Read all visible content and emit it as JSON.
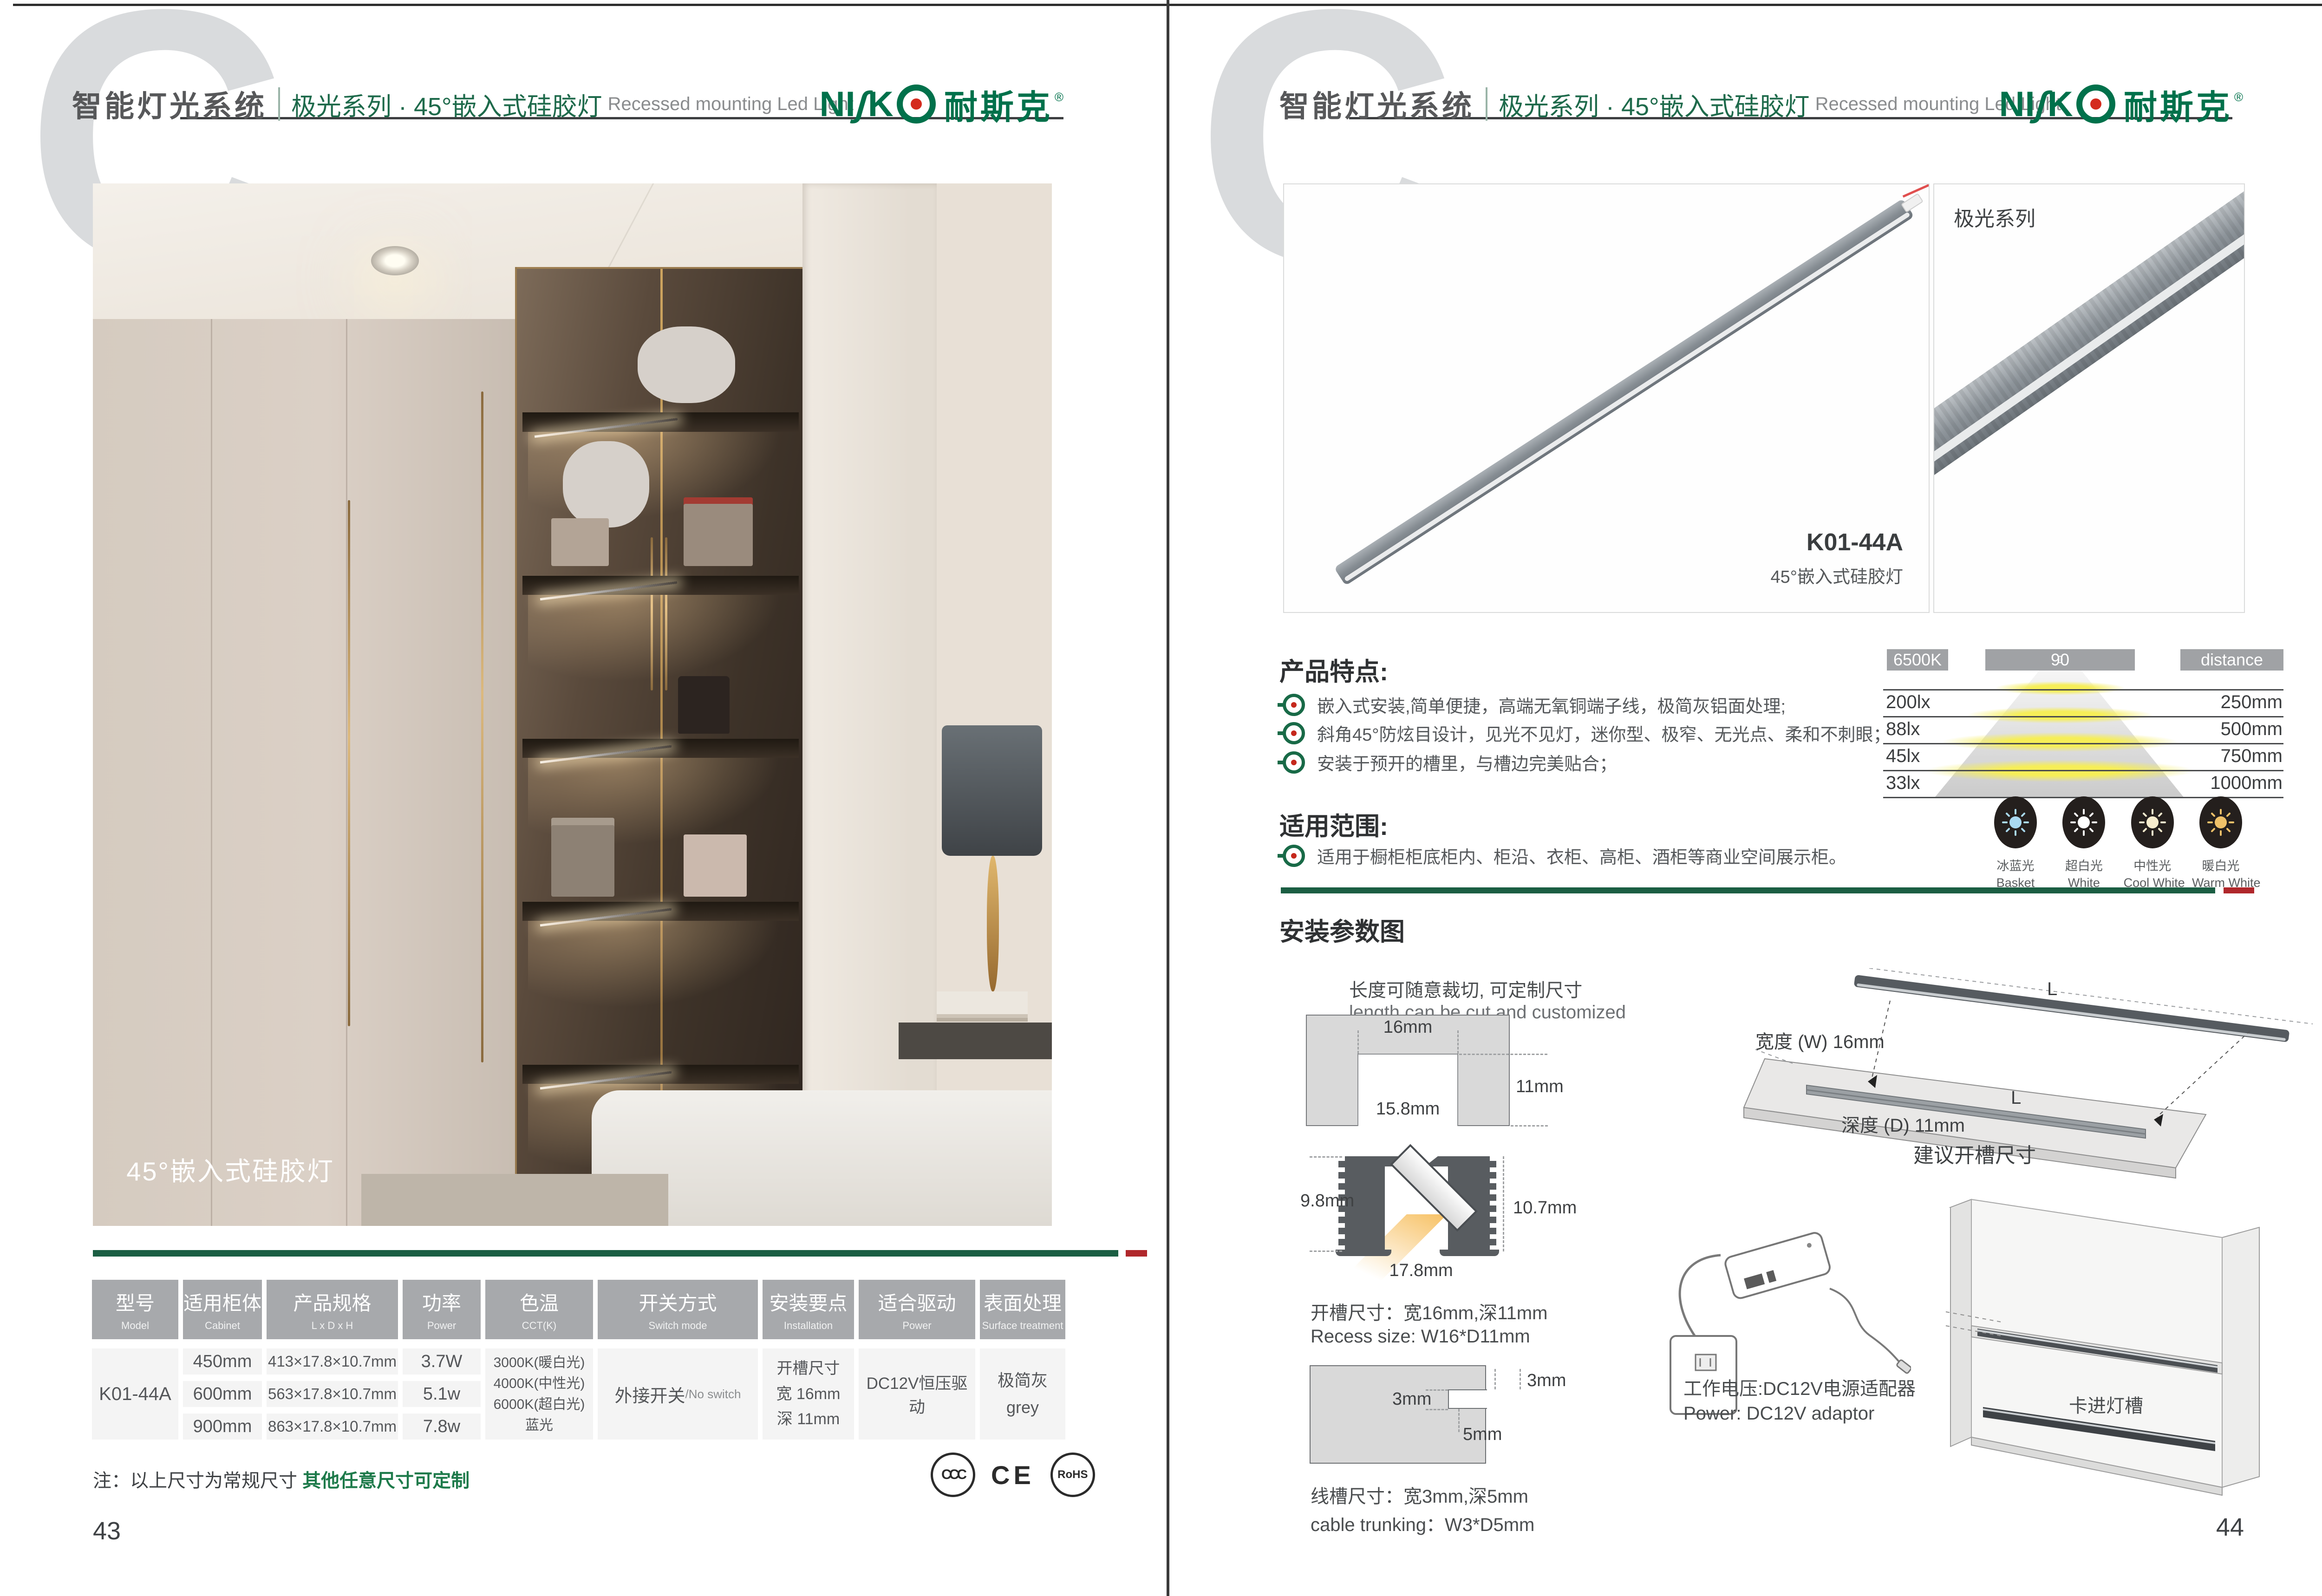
{
  "colors": {
    "brand_green": "#00714b",
    "series_green": "#1e6a4b",
    "divider_green": "#1b5e43",
    "divider_red": "#b0272b",
    "table_header_gray": "#a7a9ac",
    "text_gray": "#55575a",
    "logo_dot_red": "#d42b1e"
  },
  "header": {
    "watermark_letter": "C",
    "system_title": "智能灯光系统",
    "series_title": "极光系列 · 45°嵌入式硅胶灯",
    "series_subtitle_en": "Recessed mounting Led Light",
    "logo": {
      "part_ni": "NI",
      "part_s": "ʃ",
      "part_k": "K",
      "cn": "耐斯克",
      "reg": "®"
    }
  },
  "left_page": {
    "photo_caption": "45°嵌入式硅胶灯",
    "page_number": "43",
    "note": {
      "prefix": "注：以上尺寸为常规尺寸 ",
      "highlight": "其他任意尺寸可定制"
    },
    "certs": {
      "ccc": "CCC",
      "ce": "CE",
      "rohs": "RoHS"
    },
    "table": {
      "headers": [
        {
          "cn": "型号",
          "en": "Model"
        },
        {
          "cn": "适用柜体",
          "en": "Cabinet"
        },
        {
          "cn": "产品规格",
          "en": "L x D x H"
        },
        {
          "cn": "功率",
          "en": "Power"
        },
        {
          "cn": "色温",
          "en": "CCT(K)"
        },
        {
          "cn": "开关方式",
          "en": "Switch mode"
        },
        {
          "cn": "安装要点",
          "en": "Installation"
        },
        {
          "cn": "适合驱动",
          "en": "Power"
        },
        {
          "cn": "表面处理",
          "en": "Surface treatment"
        }
      ],
      "model": "K01-44A",
      "rows": [
        {
          "cabinet": "450mm",
          "spec": "413×17.8×10.7mm",
          "power": "3.7W"
        },
        {
          "cabinet": "600mm",
          "spec": "563×17.8×10.7mm",
          "power": "5.1w"
        },
        {
          "cabinet": "900mm",
          "spec": "863×17.8×10.7mm",
          "power": "7.8w"
        }
      ],
      "cct": [
        "3000K(暖白光)",
        "4000K(中性光)",
        "6000K(超白光)",
        "蓝光"
      ],
      "switch": {
        "cn": "外接开关",
        "en": "/No switch"
      },
      "installation": [
        "开槽尺寸",
        "宽 16mm",
        "深 11mm"
      ],
      "driver": "DC12V恒压驱动",
      "surface": {
        "cn": "极简灰",
        "en": "grey"
      }
    }
  },
  "right_page": {
    "page_number": "44",
    "product": {
      "model": "K01-44A",
      "name": "45°嵌入式硅胶灯",
      "series_tag": "极光系列"
    },
    "features": {
      "title": "产品特点:",
      "items": [
        "嵌入式安装,简单便捷，高端无氧铜端子线，极简灰铝面处理;",
        "斜角45°防炫目设计，见光不见灯，迷你型、极窄、无光点、柔和不刺眼；",
        "安装于预开的槽里，与槽边完美贴合；"
      ]
    },
    "scope": {
      "title": "适用范围:",
      "item": "适用于橱柜柜底柜内、柜沿、衣柜、高柜、酒柜等商业空间展示柜。"
    },
    "light_chart": {
      "type": "table",
      "headers": {
        "cct": "6500K",
        "angle": "90",
        "angle_sup": "0",
        "distance": "distance"
      },
      "rows": [
        {
          "lux": "200lx",
          "distance": "250mm"
        },
        {
          "lux": "88lx",
          "distance": "500mm"
        },
        {
          "lux": "45lx",
          "distance": "750mm"
        },
        {
          "lux": "33lx",
          "distance": "1000mm"
        }
      ]
    },
    "swatches": [
      {
        "cn": "冰蓝光",
        "en": "Basket",
        "color": "#a9d9f1"
      },
      {
        "cn": "超白光",
        "en": "White",
        "color": "#ffffff"
      },
      {
        "cn": "中性光",
        "en": "Cool White",
        "color": "#f6eccd"
      },
      {
        "cn": "暖白光",
        "en": "Warm White",
        "color": "#efc169"
      }
    ],
    "install": {
      "title": "安装参数图",
      "cut_cn": "长度可随意裁切, 可定制尺寸",
      "cut_en": "length can be cut and customized",
      "groove": {
        "top": "16mm",
        "depth": "11mm",
        "inner": "15.8mm"
      },
      "profile": {
        "left": "9.8mm",
        "right": "10.7mm",
        "bottom": "17.8mm"
      },
      "recess_cn": "开槽尺寸：宽16mm,深11mm",
      "recess_en": "Recess size: W16*D11mm",
      "trunk": {
        "t_right": "3mm",
        "t_left": "3mm",
        "t_depth": "5mm"
      },
      "trunk_cn": "线槽尺寸：宽3mm,深5mm",
      "trunk_en": "cable trunking：W3*D5mm",
      "board": {
        "bar_len": "L",
        "groove_len": "L",
        "width": "宽度 (W) 16mm",
        "depth": "深度 (D) 11mm",
        "caption": "建议开槽尺寸"
      },
      "power_cn": "工作电压:DC12V电源适配器",
      "power_en": "Power: DC12V adaptor",
      "clip_label": "卡进灯槽"
    }
  }
}
